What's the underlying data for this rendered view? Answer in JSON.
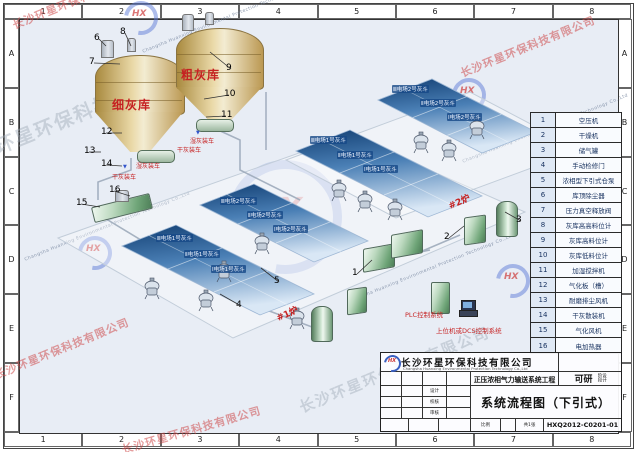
{
  "frame": {
    "columns": [
      "1",
      "2",
      "3",
      "4",
      "5",
      "6",
      "7",
      "8"
    ],
    "rows": [
      "A",
      "B",
      "C",
      "D",
      "E",
      "F"
    ]
  },
  "watermark": {
    "cn": "长沙环星环保科技有限公司",
    "en": "Changsha Huanxing Environmental Protection Technology Co.,Ltd",
    "logo": "HX"
  },
  "silos": {
    "fine": "细灰库",
    "coarse": "粗灰库",
    "wet_loading": "湿灰装车",
    "dry_loading": "干灰装车"
  },
  "boilers": {
    "b1": "#1炉",
    "b2": "#2炉"
  },
  "controls": {
    "plc": "PLC控制系统",
    "dcs": "上位机或DCS控制系统"
  },
  "hopper_banks": [
    {
      "name": "boiler2-rear",
      "labels": [
        "Ⅲ电场2号灰斗",
        "Ⅱ电场2号灰斗",
        "Ⅰ电场2号灰斗"
      ]
    },
    {
      "name": "boiler2-front",
      "labels": [
        "Ⅲ电场1号灰斗",
        "Ⅱ电场1号灰斗",
        "Ⅰ电场1号灰斗"
      ]
    },
    {
      "name": "boiler1-rear",
      "labels": [
        "Ⅲ电场2号灰斗",
        "Ⅱ电场2号灰斗",
        "Ⅰ电场2号灰斗"
      ]
    },
    {
      "name": "boiler1-front",
      "labels": [
        "Ⅲ电场1号灰斗",
        "Ⅱ电场1号灰斗",
        "Ⅰ电场1号灰斗"
      ]
    }
  ],
  "callouts": [
    {
      "n": "1",
      "x": 352,
      "y": 268,
      "tx": 372,
      "ty": 260
    },
    {
      "n": "2",
      "x": 444,
      "y": 232,
      "tx": 464,
      "ty": 226
    },
    {
      "n": "3",
      "x": 516,
      "y": 215,
      "tx": 505,
      "ty": 212
    },
    {
      "n": "4",
      "x": 236,
      "y": 300,
      "tx": 220,
      "ty": 294
    },
    {
      "n": "5",
      "x": 274,
      "y": 276,
      "tx": 261,
      "ty": 268
    },
    {
      "n": "6",
      "x": 94,
      "y": 33,
      "tx": 106,
      "ty": 46
    },
    {
      "n": "7",
      "x": 89,
      "y": 57,
      "tx": 120,
      "ty": 64
    },
    {
      "n": "8",
      "x": 120,
      "y": 27,
      "tx": 131,
      "ty": 46
    },
    {
      "n": "9",
      "x": 226,
      "y": 63,
      "tx": 210,
      "ty": 52
    },
    {
      "n": "10",
      "x": 224,
      "y": 89,
      "tx": 204,
      "ty": 99
    },
    {
      "n": "11",
      "x": 221,
      "y": 110,
      "tx": 206,
      "ty": 117
    },
    {
      "n": "12",
      "x": 101,
      "y": 127,
      "tx": 122,
      "ty": 133
    },
    {
      "n": "13",
      "x": 84,
      "y": 146,
      "tx": 101,
      "ty": 152
    },
    {
      "n": "14",
      "x": 101,
      "y": 159,
      "tx": 122,
      "ty": 166
    },
    {
      "n": "15",
      "x": 76,
      "y": 198,
      "tx": 100,
      "ty": 207
    },
    {
      "n": "16",
      "x": 109,
      "y": 185,
      "tx": 130,
      "ty": 196
    }
  ],
  "legend": {
    "items": [
      {
        "no": "1",
        "name": "空压机"
      },
      {
        "no": "2",
        "name": "干燥机"
      },
      {
        "no": "3",
        "name": "储气罐"
      },
      {
        "no": "4",
        "name": "手动检修门"
      },
      {
        "no": "5",
        "name": "浓相型下引式仓泵"
      },
      {
        "no": "6",
        "name": "库顶除尘器"
      },
      {
        "no": "7",
        "name": "压力真空释放阀"
      },
      {
        "no": "8",
        "name": "灰库高高料位计"
      },
      {
        "no": "9",
        "name": "灰库高料位计"
      },
      {
        "no": "10",
        "name": "灰库低料位计"
      },
      {
        "no": "11",
        "name": "加湿搅拌机"
      },
      {
        "no": "12",
        "name": "气化板（槽）"
      },
      {
        "no": "13",
        "name": "耐磨排尘风机"
      },
      {
        "no": "14",
        "name": "干灰散装机"
      },
      {
        "no": "15",
        "name": "气化风机"
      },
      {
        "no": "16",
        "name": "电加热器"
      }
    ]
  },
  "title_block": {
    "logo": "HX",
    "company_cn": "长沙环星环保科技有限公司",
    "company_en": "Changsha Huanxing Environmental Protection Technology Co.,Ltd",
    "project": "正压浓相气力输送系统工程",
    "stage": "可研",
    "stage_note": "设计阶段",
    "fields": [
      "设计",
      "校核",
      "审核"
    ],
    "scale_label": "比例",
    "sheet_label": "共1张",
    "drawing_title": "系统流程图（下引式）",
    "drawing_no": "HXQ2012-C0201-01"
  }
}
